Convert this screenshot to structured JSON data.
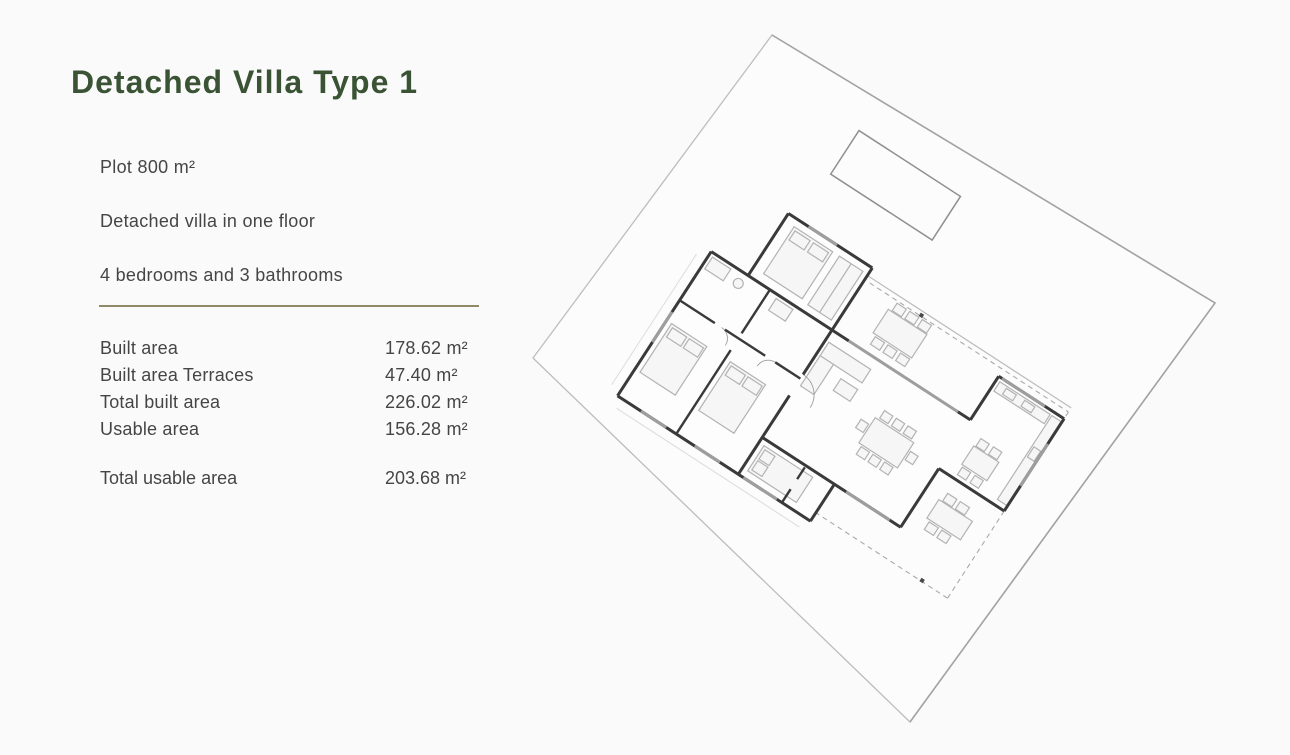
{
  "page": {
    "background": "#fafafa"
  },
  "panel": {
    "title": "Detached Villa Type 1",
    "title_color": "#3a5334",
    "text_color": "#454545",
    "divider_color": "#8f8968",
    "features": [
      "Plot 800 m²",
      "Detached villa in one floor",
      "4 bedrooms and 3 bathrooms"
    ],
    "areas": [
      {
        "label": "Built area",
        "value": "178.62 m²"
      },
      {
        "label": "Built area Terraces",
        "value": "47.40 m²"
      },
      {
        "label": "Total built area",
        "value": "226.02 m²"
      },
      {
        "label": "Usable area",
        "value": "156.28 m²"
      }
    ],
    "total": {
      "label": "Total usable area",
      "value": "203.68 m²"
    }
  },
  "floorplan": {
    "description": "rotated site plan of detached villa with pool and terraces",
    "rotation_deg": 33,
    "colors": {
      "plot_line": "#bdbdbd",
      "plot_line_dark": "#a3a3a3",
      "wall": "#3a3a3a",
      "window": "#9e9e9e",
      "furniture": "#b3b3b3",
      "dashed": "#a9a9a9",
      "pergola": "#bcbcbc",
      "pool": "#8f8f8f",
      "marker": "#4a4a4a",
      "paving": "#dcdcdc"
    }
  }
}
